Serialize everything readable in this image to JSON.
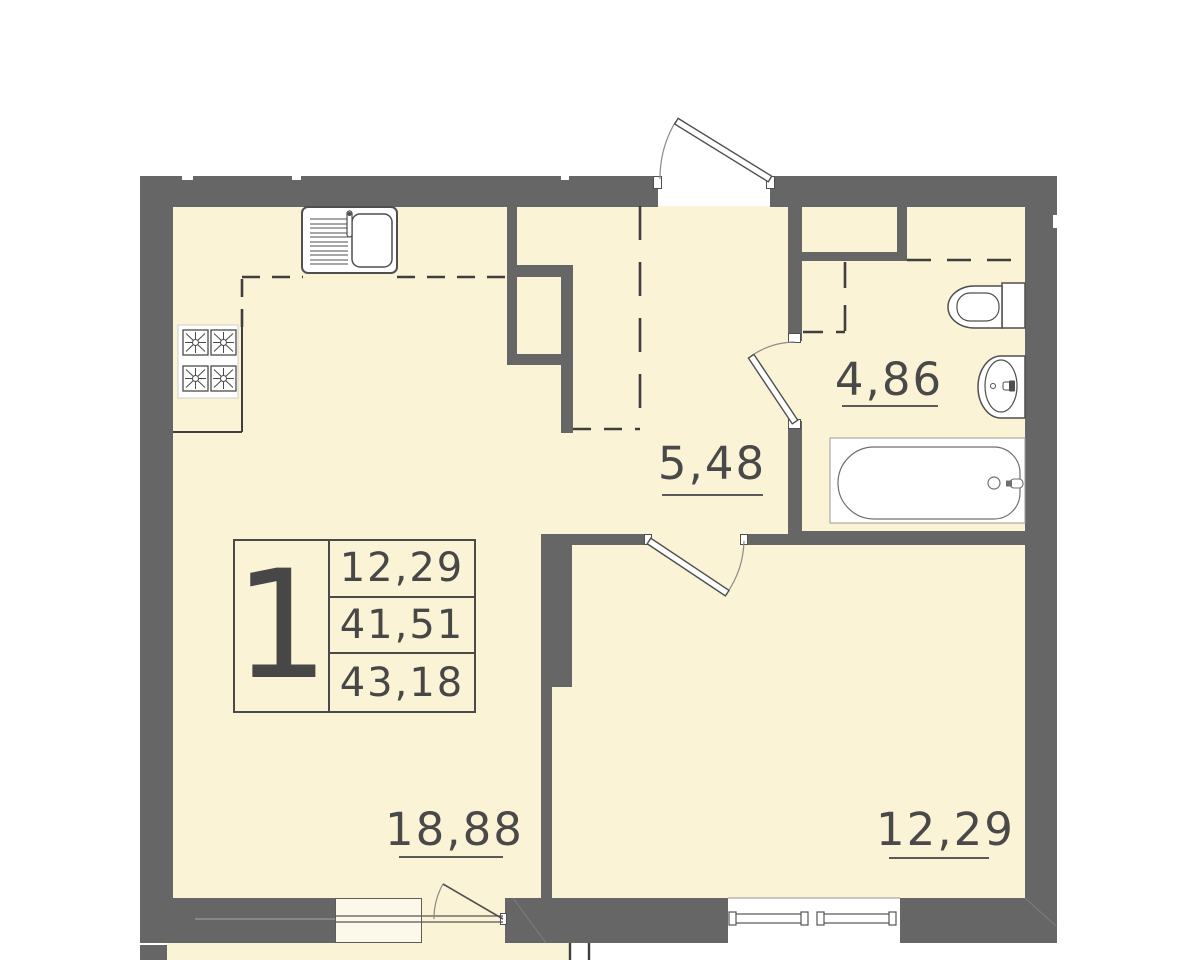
{
  "plan_title": "1-room apartment floor plan",
  "info_box": {
    "room_count": "1",
    "rows": [
      "12,29",
      "41,51",
      "43,18"
    ]
  },
  "rooms": [
    {
      "name": "bathroom",
      "area": "4,86"
    },
    {
      "name": "hallway",
      "area": "5,48"
    },
    {
      "name": "living-room",
      "area": "18,88"
    },
    {
      "name": "bedroom",
      "area": "12,29"
    }
  ],
  "fixtures": [
    "kitchen-sink",
    "stove-4-burner",
    "toilet",
    "washbasin",
    "bathtub"
  ],
  "colors": {
    "wall": "#666666",
    "floor": "#FAF3D6",
    "line": "#4A4A4A",
    "fixture_bg": "#FFFFFF"
  }
}
